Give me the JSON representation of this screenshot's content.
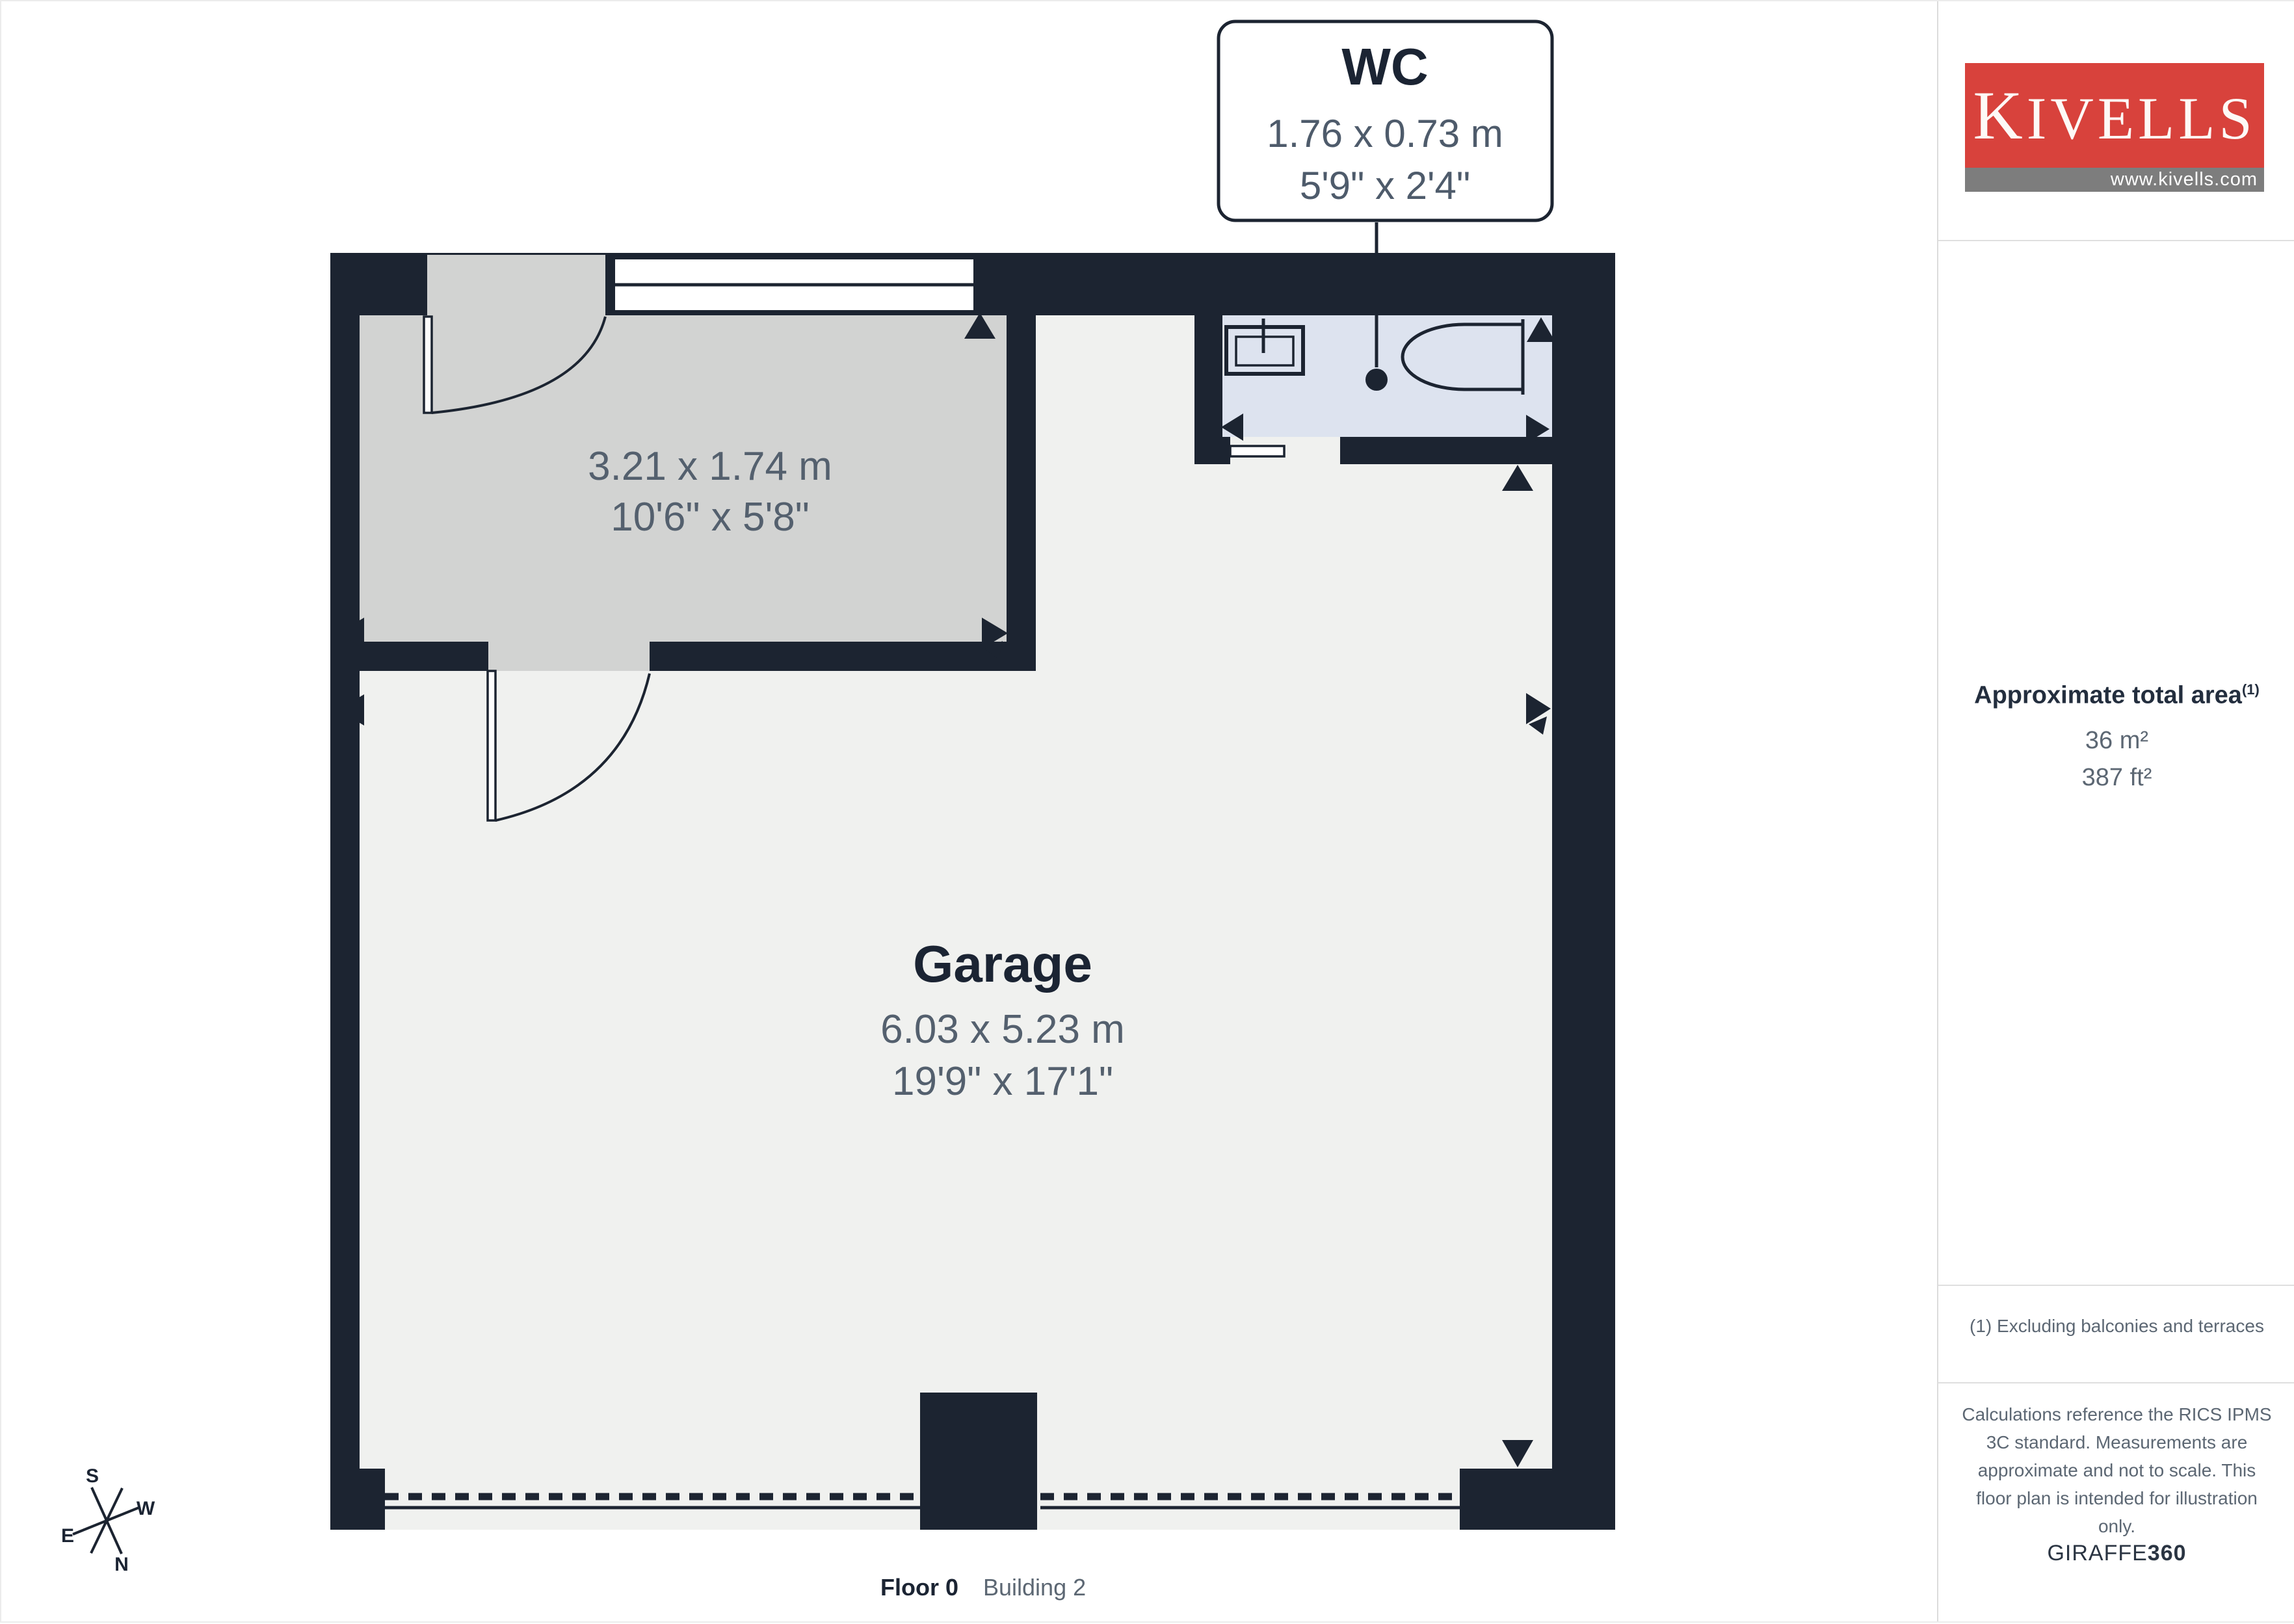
{
  "colors": {
    "wall": "#1c2431",
    "garage_floor": "#f0f1ef",
    "entrance_floor": "#d2d3d2",
    "wc_floor": "#dde3ef",
    "label_dark": "#1b2433",
    "label_gray": "#54606e",
    "logo_red": "#d8423c",
    "logo_gray": "#7d7d7d"
  },
  "plan": {
    "callout": {
      "name": "WC",
      "dims_m": "1.76 x 0.73 m",
      "dims_ft": "5'9\" x 2'4\""
    },
    "entrance_room": {
      "dims_m": "3.21 x 1.74 m",
      "dims_ft": "10'6\" x 5'8\""
    },
    "garage_room": {
      "name": "Garage",
      "dims_m": "6.03 x 5.23 m",
      "dims_ft": "19'9\" x 17'1\""
    },
    "floor_label": "Floor 0",
    "building_label": "Building 2",
    "compass": {
      "n": "N",
      "s": "S",
      "e": "E",
      "w": "W"
    }
  },
  "sidebar": {
    "logo": {
      "text": "KIVELLS",
      "url": "www.kivells.com"
    },
    "area": {
      "title": "Approximate total area",
      "superscript": "(1)",
      "sqm": "36 m²",
      "sqft": "387 ft²"
    },
    "footnote": "(1) Excluding balconies and terraces",
    "disclaimer": "Calculations reference the RICS IPMS 3C standard. Measurements are approximate and not to scale. This floor plan is intended for illustration only.",
    "brand": {
      "name": "GIRAFFE",
      "num": "360"
    }
  }
}
